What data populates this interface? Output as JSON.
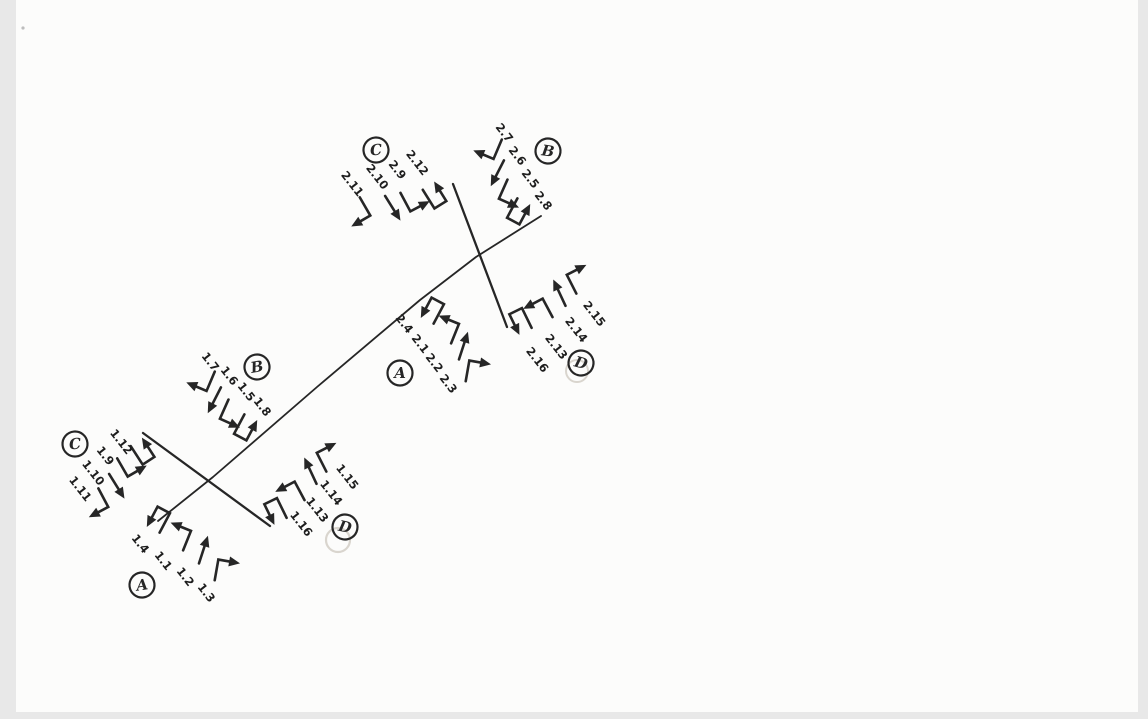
{
  "document": {
    "kind": "hand-drawn traffic turning-movement diagram",
    "colors": {
      "background": "#e8e8e8",
      "paper": "#fcfcfb",
      "ink": "#262626",
      "pencil_ghost": "#d9d5ce"
    },
    "intersections": [
      {
        "name": "intersection-1",
        "approaches": [
          {
            "label": "A",
            "movements": [
              {
                "num": "1.4",
                "icon": "uturn-arrow-icon"
              },
              {
                "num": "1.1",
                "icon": "left-turn-arrow-icon"
              },
              {
                "num": "1.2",
                "icon": "through-arrow-icon"
              },
              {
                "num": "1.3",
                "icon": "right-turn-arrow-icon"
              }
            ]
          },
          {
            "label": "B",
            "movements": [
              {
                "num": "1.7",
                "icon": "right-turn-arrow-icon"
              },
              {
                "num": "1.6",
                "icon": "through-arrow-icon"
              },
              {
                "num": "1.5",
                "icon": "left-turn-arrow-icon"
              },
              {
                "num": "1.8",
                "icon": "uturn-arrow-icon"
              }
            ]
          },
          {
            "label": "C",
            "movements": [
              {
                "num": "1.11",
                "icon": "right-turn-arrow-icon"
              },
              {
                "num": "1.10",
                "icon": "through-arrow-icon"
              },
              {
                "num": "1.9",
                "icon": "left-turn-arrow-icon"
              },
              {
                "num": "1.12",
                "icon": "uturn-arrow-icon"
              }
            ]
          },
          {
            "label": "D",
            "movements": [
              {
                "num": "1.16",
                "icon": "uturn-arrow-icon"
              },
              {
                "num": "1.13",
                "icon": "left-turn-arrow-icon"
              },
              {
                "num": "1.14",
                "icon": "through-arrow-icon"
              },
              {
                "num": "1.15",
                "icon": "right-turn-arrow-icon"
              }
            ]
          }
        ]
      },
      {
        "name": "intersection-2",
        "approaches": [
          {
            "label": "A",
            "movements": [
              {
                "num": "2.4",
                "icon": "uturn-arrow-icon"
              },
              {
                "num": "2.1",
                "icon": "left-turn-arrow-icon"
              },
              {
                "num": "2.2",
                "icon": "through-arrow-icon"
              },
              {
                "num": "2.3",
                "icon": "right-turn-arrow-icon"
              }
            ]
          },
          {
            "label": "B",
            "movements": [
              {
                "num": "2.7",
                "icon": "right-turn-arrow-icon"
              },
              {
                "num": "2.6",
                "icon": "through-arrow-icon"
              },
              {
                "num": "2.5",
                "icon": "left-turn-arrow-icon"
              },
              {
                "num": "2.8",
                "icon": "uturn-arrow-icon"
              }
            ]
          },
          {
            "label": "C",
            "movements": [
              {
                "num": "2.11",
                "icon": "right-turn-arrow-icon"
              },
              {
                "num": "2.10",
                "icon": "through-arrow-icon"
              },
              {
                "num": "2.9",
                "icon": "left-turn-arrow-icon"
              },
              {
                "num": "2.12",
                "icon": "uturn-arrow-icon"
              }
            ]
          },
          {
            "label": "D",
            "movements": [
              {
                "num": "2.16",
                "icon": "uturn-arrow-icon"
              },
              {
                "num": "2.13",
                "icon": "left-turn-arrow-icon"
              },
              {
                "num": "2.14",
                "icon": "through-arrow-icon"
              },
              {
                "num": "2.15",
                "icon": "right-turn-arrow-icon"
              }
            ]
          }
        ]
      }
    ]
  }
}
